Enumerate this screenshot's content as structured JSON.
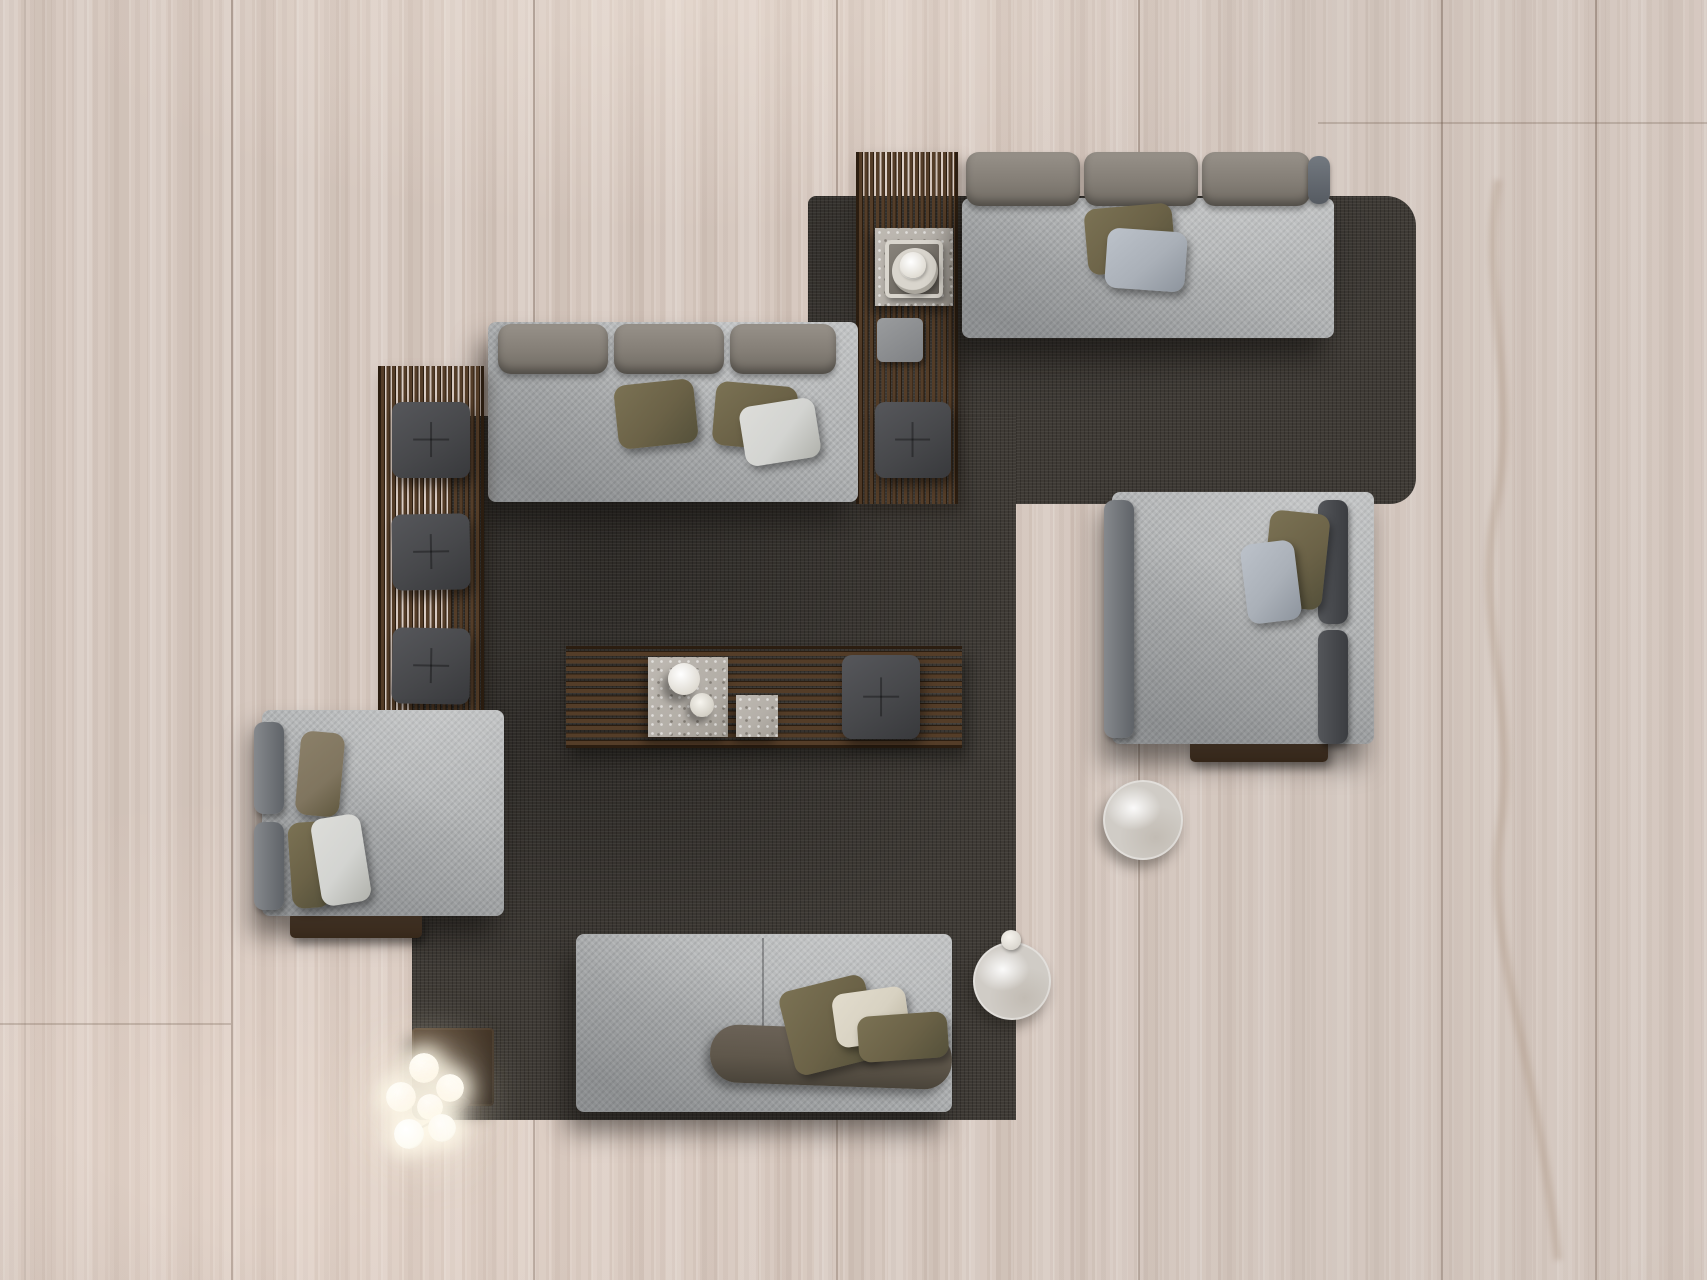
{
  "scene": {
    "title": "Top-down view of a living room furniture arrangement on a travertine floor",
    "palette": {
      "floor": "#d7c9c0",
      "rug": "#3e3a35",
      "fabric": "#b2b4b5",
      "olive": "#6b6247",
      "taupe": "#80755f",
      "pillowGray": "#aab0b8",
      "pillowWhite": "#d3d4d1",
      "cream": "#d8d2c2",
      "cushionDark": "#47484b",
      "seatBolster": "#5f574b",
      "wood": "#543d28",
      "woodDark": "#2b1d10",
      "woodBar": "#5e4631",
      "stone": "#b4afa8",
      "marble": "#d0ccc6",
      "tableDark": "#3a2d21",
      "bulb": "#fdfbf2"
    },
    "objects": {
      "floorMaterial": {
        "label": "Travertine plank floor"
      },
      "rug": {
        "label": "Charcoal woven area rug"
      },
      "slatConsole": {
        "label": "Slatted teak console"
      },
      "stoneSideTable": {
        "label": "Stone side table with tray, plate and cup"
      },
      "slatPad": {
        "label": "Gray seat pad on slat console"
      },
      "poufTop": {
        "label": "Dark tufted square pouf"
      },
      "sofaTopRight": {
        "label": "Three-seat sofa with back bolsters and two pillows"
      },
      "sofaMiddle": {
        "label": "Three-seat sofa with back bolsters and three pillows"
      },
      "slatBench": {
        "label": "Slatted teak bench"
      },
      "ottoman": {
        "label": "Dark tufted ottoman"
      },
      "coffeeTable": {
        "label": "Low slatted coffee table"
      },
      "slabLarge": {
        "label": "Terrazzo slab with white vase and bowl"
      },
      "slabSmall": {
        "label": "Small terrazzo slab"
      },
      "poufCenter": {
        "label": "Dark tufted square pouf"
      },
      "chaiseRight": {
        "label": "Lounge daybed with bolsters and two pillows"
      },
      "chaiseLeft": {
        "label": "Lounge daybed with bolsters and three pillows"
      },
      "sofaBottom": {
        "label": "Two-module sofa with seat bolster and three pillows"
      },
      "roundTableRug": {
        "label": "Round marble side table on rug edge"
      },
      "roundTableFloor": {
        "label": "Round marble side table on floor"
      },
      "squareTable": {
        "label": "Bronze cube side table"
      },
      "floorLamp": {
        "label": "Branching floor lamp with six glowing glass globes",
        "bulbCount": 6
      }
    }
  }
}
